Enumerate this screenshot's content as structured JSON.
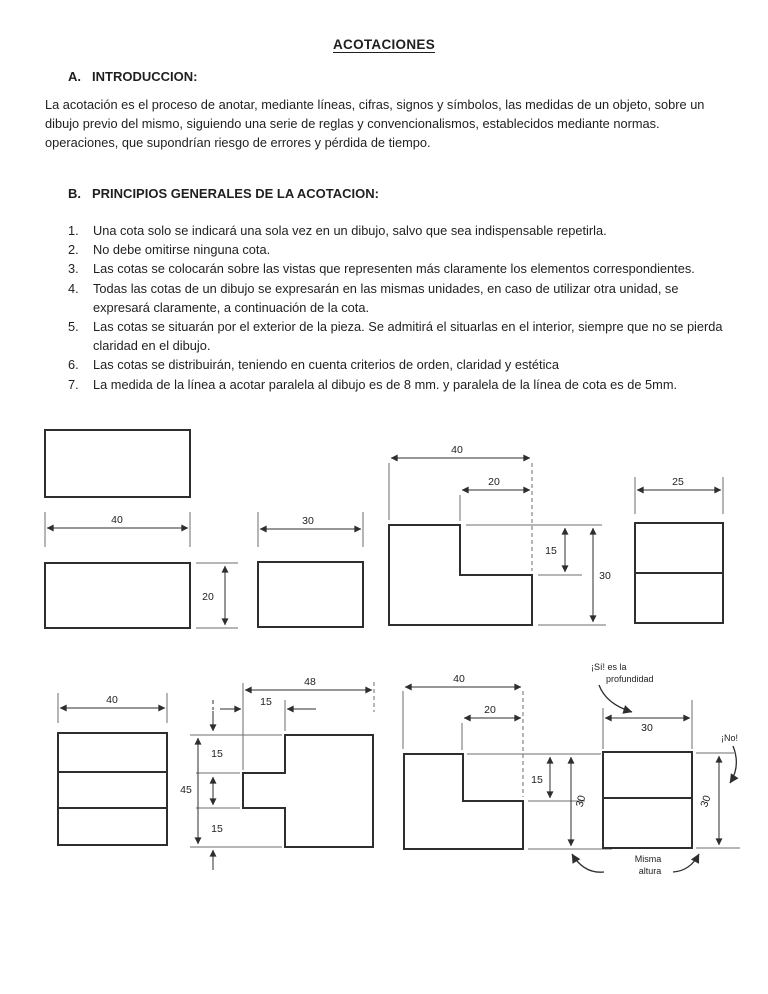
{
  "document": {
    "title": "ACOTACIONES",
    "section_a": {
      "num": "A.",
      "heading": "INTRODUCCION:",
      "paragraph_lines": [
        "La acotación es el proceso de anotar, mediante líneas, cifras, signos y símbolos, las medidas de un objeto, sobre un",
        "dibujo previo del mismo, siguiendo una serie de reglas y convencionalismos, establecidos mediante normas.",
        "operaciones, que supondrían riesgo de errores y pérdida de tiempo."
      ]
    },
    "section_b": {
      "num": "B.",
      "heading": "PRINCIPIOS GENERALES DE LA ACOTACION:",
      "items": [
        {
          "n": "1.",
          "lines": [
            "Una cota solo se indicará una sola vez en un dibujo, salvo que sea indispensable repetirla."
          ]
        },
        {
          "n": "2.",
          "lines": [
            "No debe omitirse ninguna cota."
          ]
        },
        {
          "n": "3.",
          "lines": [
            "Las cotas se colocarán sobre las vistas que representen más claramente los elementos correspondientes."
          ]
        },
        {
          "n": "4.",
          "lines": [
            "Todas las cotas de un dibujo se expresarán en las mismas unidades, en caso de utilizar otra unidad, se",
            "expresará claramente, a continuación de la cota."
          ]
        },
        {
          "n": "5.",
          "lines": [
            "Las cotas se situarán por el exterior de la pieza. Se admitirá el situarlas en el interior, siempre que no se pierda",
            "claridad en el dibujo."
          ]
        },
        {
          "n": "6.",
          "lines": [
            "Las cotas se distribuirán, teniendo en cuenta criterios de orden, claridad y estética"
          ]
        },
        {
          "n": "7.",
          "lines": [
            "La medida de la línea a acotar paralela al dibujo es de 8 mm. y paralela de la línea de cota es de 5mm."
          ]
        }
      ]
    }
  },
  "figures": {
    "fig1": {
      "dim_w": "40",
      "dim_h": "20"
    },
    "fig2": {
      "dim_w": "30"
    },
    "fig3": {
      "dim_total_w": "40",
      "dim_step_w": "20",
      "dim_step_h": "15",
      "dim_total_h": "30"
    },
    "fig4": {
      "dim_w": "25"
    },
    "fig5": {
      "dim_w": "40"
    },
    "fig6": {
      "dim_total_w": "48",
      "dim_tab_w": "15",
      "dim_total_h": "45",
      "dim_seg_top": "15",
      "dim_seg_bottom": "15"
    },
    "fig7": {
      "dim_total_w": "40",
      "dim_step_w": "20",
      "dim_step_h": "15",
      "dim_total_h": "30"
    },
    "fig8": {
      "dim_w": "30",
      "dim_h": "30",
      "note_si_line1": "¡Sí! es la",
      "note_si_line2": "profundidad",
      "note_no": "¡No!",
      "note_misma_line1": "Misma",
      "note_misma_line2": "altura"
    }
  },
  "colors": {
    "ink": "#1f1f1f",
    "line": "#2e2e2e"
  }
}
